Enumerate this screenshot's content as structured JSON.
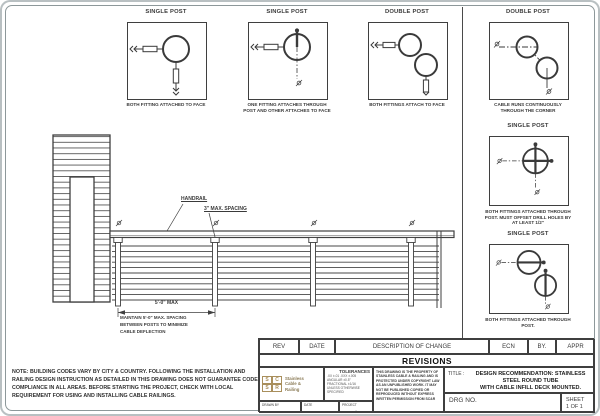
{
  "details": [
    {
      "title": "SINGLE POST",
      "caption": "BOTH FITTING ATTACHED TO FACE"
    },
    {
      "title": "SINGLE POST",
      "caption": "ONE FITTING ATTACHES THROUGH POST AND OTHER ATTACHES TO FACE"
    },
    {
      "title": "DOUBLE POST",
      "caption": "BOTH FITTINGS ATTACH TO FACE"
    },
    {
      "title": "DOUBLE POST",
      "caption": "CABLE RUNS CONTINUOUSLY THROUGH THE CORNER"
    },
    {
      "title": "SINGLE POST",
      "caption": "BOTH FITTINGS ATTACHED THROUGH POST. MUST OFFSET DRILL HOLES BY AT LEAST 1/2\""
    },
    {
      "title": "SINGLE POST",
      "caption": "BOTH FITTINGS ATTACHED THROUGH POST."
    }
  ],
  "elevation": {
    "handrail_label": "HANDRAIL",
    "spacing_label": "3\" MAX. SPACING",
    "dim_label": "5'-0\" MAX",
    "spacing_note": "MAINTAIN 5'-0\" MAX. SPACING\nBETWEEN POSTS TO MINIMIZE\nCABLE DEFLECTION"
  },
  "site_note": "NOTE: BUILDING CODES VARY BY CITY & COUNTRY. FOLLOWING THE INSTALLATION AND RAILING DESIGN INSTRUCTION AS DETAILED IN THIS DRAWING DOES NOT GUARANTEE CODE COMPLIANCE IN ALL AREAS. BEFORE STARTING THE PROJECT, CHECK WITH LOCAL REQUIREMENT FOR USING AND INSTALLING CABLE RAILINGS.",
  "title_block": {
    "headers": {
      "rev": "REV",
      "date": "DATE",
      "description": "DESCRIPTION OF CHANGE",
      "ecn": "ECN",
      "by": "BY.",
      "appr": "APPR"
    },
    "revisions_label": "REVISIONS",
    "company": {
      "logo_letters": [
        "S",
        "C",
        "S",
        "R"
      ],
      "name": "Stainless\nCable &\nRailing"
    },
    "tolerances": {
      "label": "TOLERANCES",
      "body": ".XX ±.01  .XXX ±.005\nANGULAR ±0.5°\nFRACTIONAL ±1/16\nUNLESS OTHERWISE SPECIFIED"
    },
    "copyright": "THIS DRAWING IS THE PROPERTY OF STAINLESS CABLE & RAILING AND IS PROTECTED UNDER COPYRIGHT LAW AS AN UNPUBLISHED WORK. IT MAY NOT BE PUBLISHED COPIED OR REPRODUCED WITHOUT EXPRESS WRITTEN PERMISSION FROM SC&R",
    "title_label": "TITLE :",
    "title_text": "DESIGN RECOMMENDATION: STAINLESS\nSTEEL ROUND TUBE\nWITH CABLE INFILL DECK MOUNTED.",
    "drg_label": "DRG NO.",
    "sheet_label": "SHEET\n1 OF 1",
    "drawn_by_label": "DRAWN BY",
    "date_label": "DATE",
    "project_label": "PROJECT",
    "project_value": "-"
  }
}
